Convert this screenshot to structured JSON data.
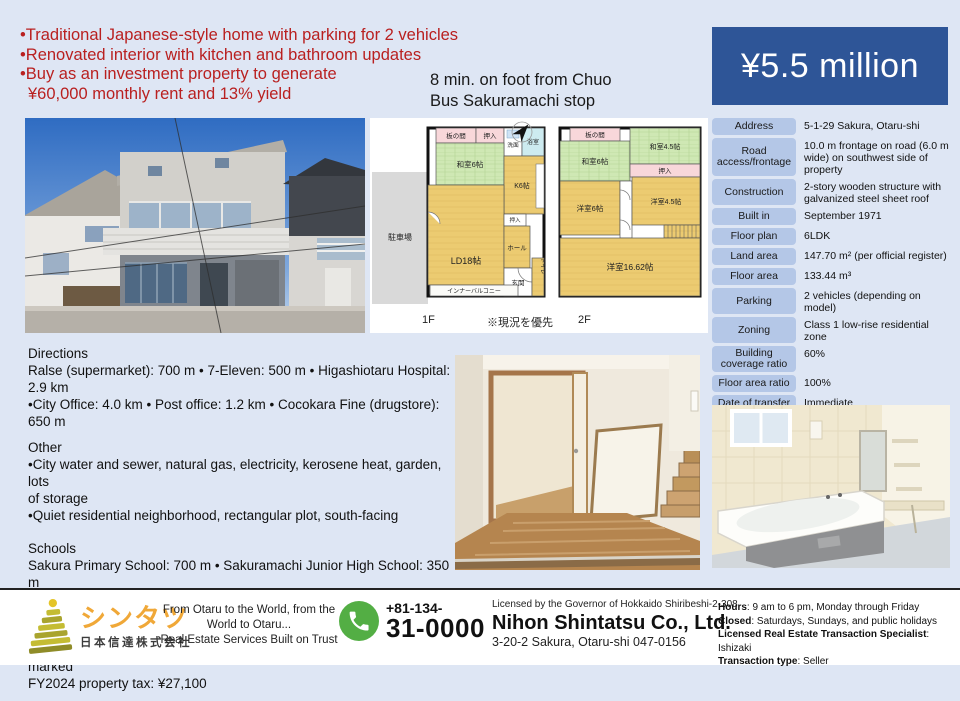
{
  "colors": {
    "background": "#dee6f4",
    "price_box": "#2e5597",
    "accent_red": "#b92020",
    "table_label": "#b4c7e7",
    "phone_green": "#53ae44",
    "brand_gold": "#f0a838"
  },
  "highlights": {
    "bullets": [
      "•Traditional Japanese-style home with parking for 2 vehicles",
      "•Renovated interior with kitchen and bathroom updates",
      "•Buy as an investment property to generate",
      "¥60,000 monthly rent and 13% yield"
    ]
  },
  "access_note": {
    "line1": "8 min. on foot from Chuo",
    "line2": "Bus Sakuramachi stop"
  },
  "price": {
    "amount": "¥5.5 million"
  },
  "details": {
    "rows": [
      {
        "label": "Address",
        "value": "5-1-29 Sakura, Otaru-shi"
      },
      {
        "label": "Road access/frontage",
        "value": "10.0 m frontage on road (6.0 m wide) on southwest side of property"
      },
      {
        "label": "Construction",
        "value": "2-story wooden structure with galvanized steel sheet roof"
      },
      {
        "label": "Built in",
        "value": "September 1971"
      },
      {
        "label": "Floor plan",
        "value": "6LDK"
      },
      {
        "label": "Land area",
        "value": "147.70 m² (per official register)"
      },
      {
        "label": "Floor area",
        "value": "133.44 m³"
      },
      {
        "label": "Parking",
        "value": "2 vehicles (depending on model)"
      },
      {
        "label": "Zoning",
        "value": "Class 1 low-rise residential zone"
      },
      {
        "label": "Building coverage ratio",
        "value": "60%"
      },
      {
        "label": "Floor area ratio",
        "value": "100%"
      },
      {
        "label": "Date of transfer",
        "value": "Immediate"
      },
      {
        "label": "Current status",
        "value": "Vacant"
      }
    ]
  },
  "floorplan": {
    "floor1_label": "1F",
    "floor2_label": "2F",
    "note": "※現況を優先",
    "f1": {
      "parking": "駐車場",
      "itanoma": "板の間",
      "oshiire": "押入",
      "senmen": "洗面",
      "bath": "浴室",
      "washitsu": "和室6帖",
      "kitchen": "K6帖",
      "living": "LD18帖",
      "hall": "ホール",
      "oshiire2": "押入",
      "genkan": "玄関",
      "toilet": "トイレ",
      "balcony": "インナーバルコニー"
    },
    "f2": {
      "itanoma": "板の間",
      "washitsu6": "和室6帖",
      "washitsu45": "和室4.5帖",
      "oshiire": "押入",
      "yoshitsu6": "洋室6帖",
      "yoshitsu45": "洋室4.5帖",
      "yoshitsu16": "洋室16.62帖"
    }
  },
  "descriptions": {
    "sections": [
      {
        "heading": "Directions",
        "lines": [
          "Ralse (supermarket): 700 m • 7-Eleven: 500 m • Higashiotaru Hospital: 2.9 km",
          "•City Office: 4.0 km • Post office: 1.2 km • Cocokara Fine (drugstore): 650 m"
        ]
      },
      {
        "heading": "Other",
        "lines": [
          "•City water and sewer, natural gas, electricity, kerosene heat, garden, lots",
          "of storage",
          "•Quiet residential neighborhood, rectangular plot, south-facing"
        ]
      },
      {
        "heading": "Schools",
        "lines": [
          "Sakura Primary School: 700 m • Sakuramachi Junior High School: 350 m"
        ]
      },
      {
        "heading": "Remarks",
        "lines": [
          "Exempt from contractual non-conformity liability; sold as-is; boundaries not",
          "marked",
          "FY2024 property tax: ¥27,100"
        ]
      }
    ]
  },
  "footer": {
    "brand": {
      "name_kana": "シンタツ",
      "name_jp": "日本信達株式会社"
    },
    "tagline": {
      "line1": "From Otaru to the World, from the",
      "line2": "World to Otaru...",
      "line3": "Real Estate Services Built on Trust"
    },
    "phone": {
      "area": "+81-134-",
      "number": "31-0000"
    },
    "company": {
      "license": "Licensed by the Governor of Hokkaido Shiribeshi-2-308",
      "name": "Nihon Shintatsu Co., Ltd.",
      "address": "3-20-2 Sakura, Otaru-shi 047-0156"
    },
    "info": {
      "hours_label": "Hours",
      "hours": ": 9 am to 6 pm, Monday through Friday",
      "closed_label": "Closed",
      "closed": ": Saturdays, Sundays, and public holidays",
      "specialist_label": "Licensed Real Estate Transaction Specialist",
      "specialist": ": Ishizaki",
      "type_label": "Transaction type",
      "type": ": Seller"
    }
  }
}
